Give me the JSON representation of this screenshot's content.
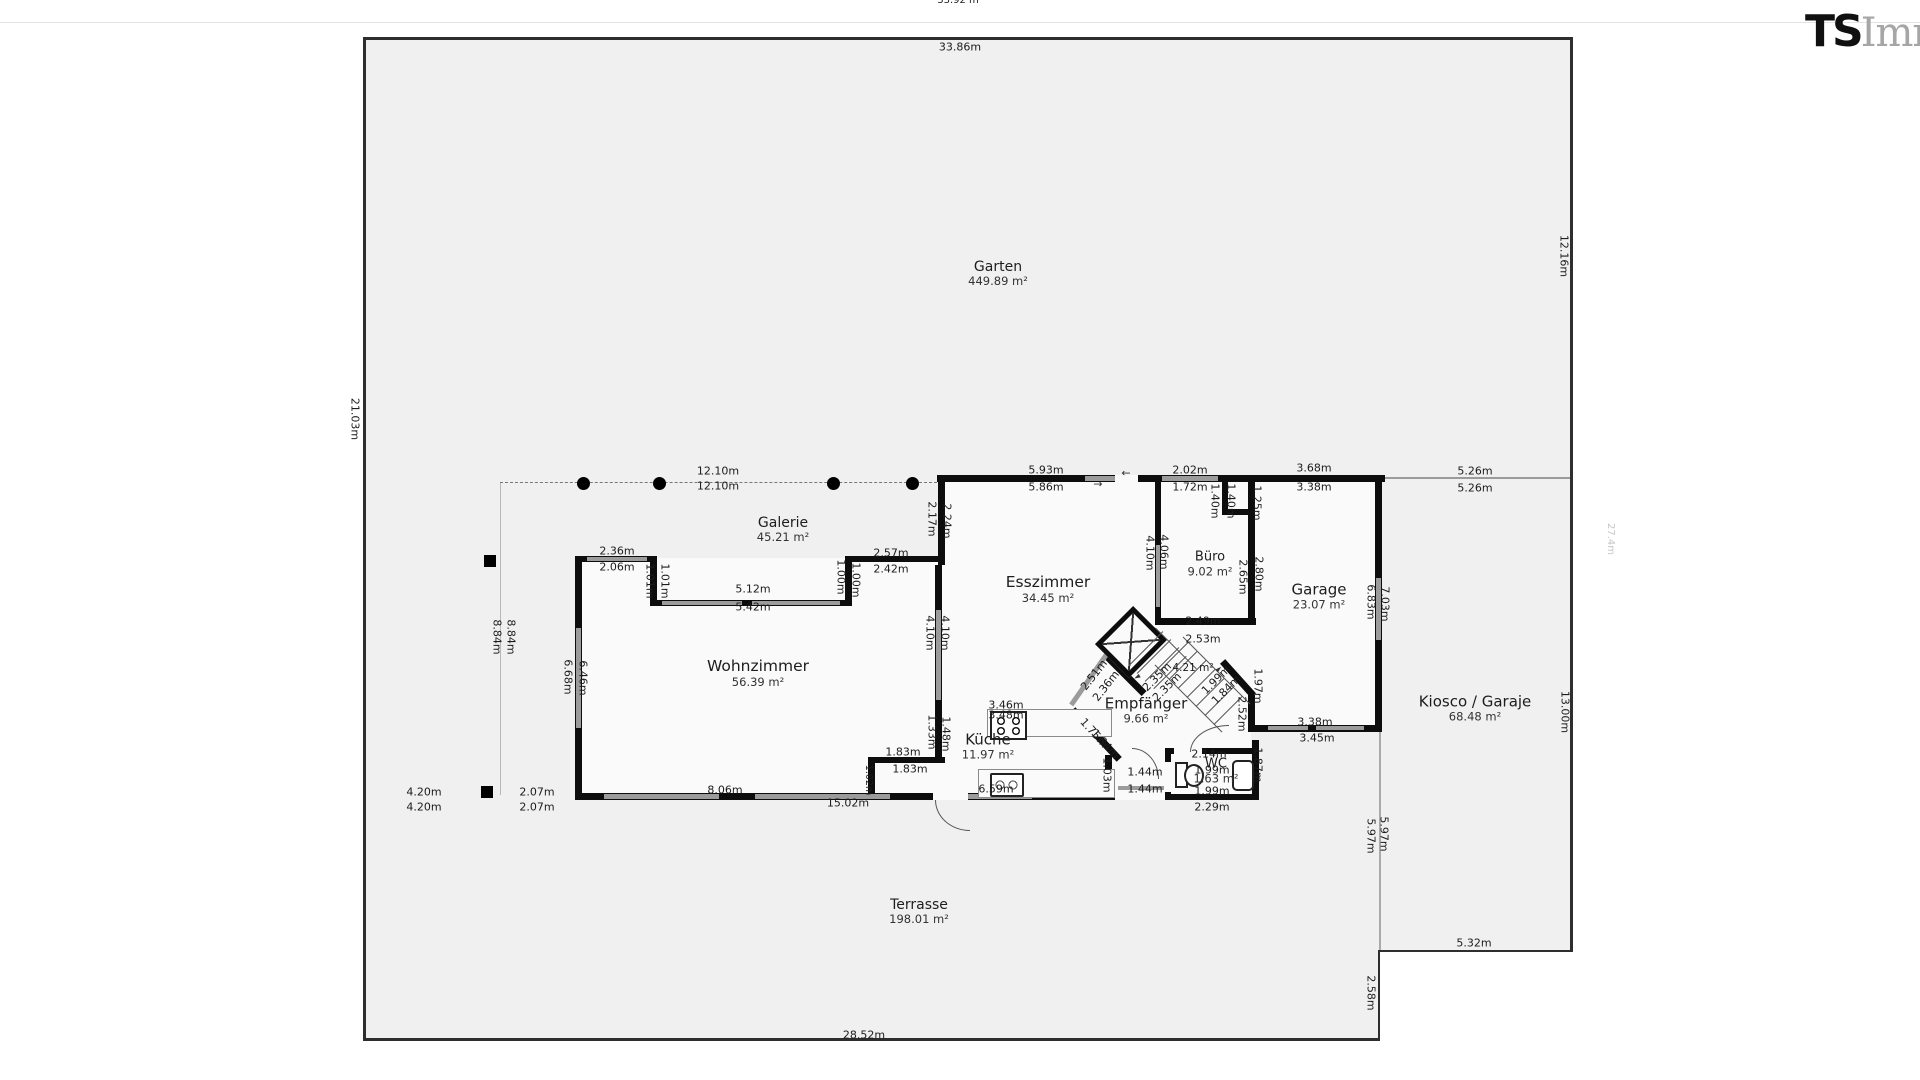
{
  "logo": {
    "bold": "TS",
    "light": "Immo"
  },
  "rooms": [
    {
      "name": "Garten",
      "area": "449.89 m²",
      "x": 998,
      "y": 274,
      "s": 14
    },
    {
      "name": "Galerie",
      "area": "45.21 m²",
      "x": 783,
      "y": 530,
      "s": 14
    },
    {
      "name": "Wohnzimmer",
      "area": "56.39 m²",
      "x": 758,
      "y": 674,
      "s": 15.5
    },
    {
      "name": "Esszimmer",
      "area": "34.45 m²",
      "x": 1048,
      "y": 590,
      "s": 15.5
    },
    {
      "name": "Büro",
      "area": "9.02 m²",
      "x": 1210,
      "y": 565,
      "s": 13
    },
    {
      "name": "Garage",
      "area": "23.07 m²",
      "x": 1319,
      "y": 597,
      "s": 15
    },
    {
      "name": "Kiosco / Garaje",
      "area": "68.48 m²",
      "x": 1475,
      "y": 709,
      "s": 15
    },
    {
      "name": "Empfänger",
      "area": "9.66 m²",
      "x": 1146,
      "y": 711,
      "s": 15
    },
    {
      "name": "Küche",
      "area": "11.97 m²",
      "x": 988,
      "y": 747,
      "s": 15
    },
    {
      "name": "WC",
      "area": "1.63 m²",
      "x": 1216,
      "y": 772,
      "s": 13
    },
    {
      "name": "Terrasse",
      "area": "198.01 m²",
      "x": 919,
      "y": 912,
      "s": 14
    }
  ],
  "dim_labels": [
    {
      "t": "33.92 m",
      "x": 958,
      "y": 1,
      "s": 10
    },
    {
      "t": "33.86m",
      "x": 960,
      "y": 47
    },
    {
      "t": "12.10m",
      "x": 718,
      "y": 471
    },
    {
      "t": "12.10m",
      "x": 718,
      "y": 486
    },
    {
      "t": "5.93m",
      "x": 1046,
      "y": 470
    },
    {
      "t": "5.86m",
      "x": 1046,
      "y": 487
    },
    {
      "t": "2.02m",
      "x": 1190,
      "y": 470
    },
    {
      "t": "1.72m",
      "x": 1190,
      "y": 487
    },
    {
      "t": "3.68m",
      "x": 1314,
      "y": 468
    },
    {
      "t": "3.38m",
      "x": 1314,
      "y": 487
    },
    {
      "t": "5.26m",
      "x": 1475,
      "y": 471
    },
    {
      "t": "5.26m",
      "x": 1475,
      "y": 488
    },
    {
      "t": "1.40m",
      "x": 1215,
      "y": 501,
      "r": 90
    },
    {
      "t": "1.40m",
      "x": 1231,
      "y": 501,
      "r": 90
    },
    {
      "t": "1.25m",
      "x": 1257,
      "y": 503,
      "r": 90
    },
    {
      "t": "2.36m",
      "x": 617,
      "y": 551
    },
    {
      "t": "2.06m",
      "x": 617,
      "y": 567
    },
    {
      "t": "1.01m",
      "x": 650,
      "y": 581,
      "r": 90
    },
    {
      "t": "1.01m",
      "x": 665,
      "y": 581,
      "r": 90
    },
    {
      "t": "5.12m",
      "x": 753,
      "y": 589
    },
    {
      "t": "5.42m",
      "x": 753,
      "y": 607
    },
    {
      "t": "1.00m",
      "x": 841,
      "y": 577,
      "r": 90
    },
    {
      "t": "1.00m",
      "x": 856,
      "y": 580,
      "r": 90
    },
    {
      "t": "2.57m",
      "x": 891,
      "y": 553
    },
    {
      "t": "2.42m",
      "x": 891,
      "y": 569
    },
    {
      "t": "2.17m",
      "x": 932,
      "y": 519,
      "r": 90
    },
    {
      "t": "2.24m",
      "x": 947,
      "y": 521,
      "r": 90
    },
    {
      "t": "4.10m",
      "x": 930,
      "y": 633,
      "r": 90
    },
    {
      "t": "4.10m",
      "x": 945,
      "y": 633,
      "r": 90
    },
    {
      "t": "4.10m",
      "x": 1150,
      "y": 553,
      "r": 90
    },
    {
      "t": "4.06m",
      "x": 1164,
      "y": 552,
      "r": 90
    },
    {
      "t": "2.49m",
      "x": 1203,
      "y": 621
    },
    {
      "t": "2.53m",
      "x": 1203,
      "y": 639
    },
    {
      "t": "2.65m",
      "x": 1243,
      "y": 577,
      "r": 90
    },
    {
      "t": "2.80m",
      "x": 1259,
      "y": 574,
      "r": 90
    },
    {
      "t": "6.83m",
      "x": 1371,
      "y": 602,
      "r": 90
    },
    {
      "t": "7.03m",
      "x": 1385,
      "y": 604,
      "r": 90
    },
    {
      "t": "3.38m",
      "x": 1315,
      "y": 722
    },
    {
      "t": "3.45m",
      "x": 1317,
      "y": 738
    },
    {
      "t": "1.97m",
      "x": 1258,
      "y": 686,
      "r": 90
    },
    {
      "t": "2.52m",
      "x": 1242,
      "y": 714,
      "r": 90
    },
    {
      "t": "1.87m",
      "x": 1258,
      "y": 765,
      "r": 90
    },
    {
      "t": "5.97m",
      "x": 1371,
      "y": 836,
      "r": 90
    },
    {
      "t": "5.97m",
      "x": 1384,
      "y": 834,
      "r": 90
    },
    {
      "t": "2.51m",
      "x": 1094,
      "y": 675,
      "r": -52
    },
    {
      "t": "2.36m",
      "x": 1106,
      "y": 686,
      "r": -52
    },
    {
      "t": "2.35m",
      "x": 1157,
      "y": 677,
      "r": -45
    },
    {
      "t": "2.35m",
      "x": 1167,
      "y": 687,
      "r": -45
    },
    {
      "t": "1.99m",
      "x": 1216,
      "y": 680,
      "r": -45
    },
    {
      "t": "1.84m",
      "x": 1226,
      "y": 690,
      "r": -45
    },
    {
      "t": "1.75m",
      "x": 1094,
      "y": 733,
      "r": 48
    },
    {
      "t": "1.84m",
      "x": 1105,
      "y": 744,
      "r": 48
    },
    {
      "t": "4.21 m²",
      "x": 1193,
      "y": 668,
      "s": 10.5
    },
    {
      "t": "2.14m",
      "x": 1209,
      "y": 754
    },
    {
      "t": "1.99m",
      "x": 1212,
      "y": 770
    },
    {
      "t": "1.99m",
      "x": 1212,
      "y": 791
    },
    {
      "t": "2.29m",
      "x": 1212,
      "y": 807
    },
    {
      "t": "1.44m",
      "x": 1145,
      "y": 772
    },
    {
      "t": "1.44m",
      "x": 1145,
      "y": 789
    },
    {
      "t": "1.03m",
      "x": 1107,
      "y": 775,
      "r": 90
    },
    {
      "t": "3.46m",
      "x": 1006,
      "y": 705
    },
    {
      "t": "3.48m",
      "x": 1006,
      "y": 715
    },
    {
      "t": "1.33m",
      "x": 932,
      "y": 732,
      "r": 90
    },
    {
      "t": "1.48m",
      "x": 946,
      "y": 734,
      "r": 90
    },
    {
      "t": "1.83m",
      "x": 903,
      "y": 752
    },
    {
      "t": "1.83m",
      "x": 910,
      "y": 769
    },
    {
      "t": "6.59m",
      "x": 996,
      "y": 789
    },
    {
      "t": "1.02m",
      "x": 868,
      "y": 780,
      "r": 90,
      "s": 9.5
    },
    {
      "t": "8.06m",
      "x": 725,
      "y": 790
    },
    {
      "t": "15.02m",
      "x": 848,
      "y": 803
    },
    {
      "t": "4.20m",
      "x": 424,
      "y": 792
    },
    {
      "t": "4.20m",
      "x": 424,
      "y": 807
    },
    {
      "t": "2.07m",
      "x": 537,
      "y": 792
    },
    {
      "t": "2.07m",
      "x": 537,
      "y": 807
    },
    {
      "t": "8.84m",
      "x": 497,
      "y": 637,
      "r": 90
    },
    {
      "t": "8.84m",
      "x": 511,
      "y": 637,
      "r": 90
    },
    {
      "t": "6.68m",
      "x": 568,
      "y": 677,
      "r": 90
    },
    {
      "t": "6.46m",
      "x": 583,
      "y": 678,
      "r": 90
    },
    {
      "t": "21.03m",
      "x": 355,
      "y": 419,
      "r": 90
    },
    {
      "t": "12.16m",
      "x": 1564,
      "y": 256,
      "r": 90
    },
    {
      "t": "13.00m",
      "x": 1565,
      "y": 712,
      "r": 90
    },
    {
      "t": "27.4m",
      "x": 1610,
      "y": 539,
      "r": 90,
      "c": "#c6c6c6",
      "s": 10
    },
    {
      "t": "5.32m",
      "x": 1474,
      "y": 943
    },
    {
      "t": "2.58m",
      "x": 1371,
      "y": 993,
      "r": 90
    },
    {
      "t": "28.52m",
      "x": 864,
      "y": 1035
    }
  ],
  "arrows": [
    {
      "t": "←",
      "x": 1126,
      "y": 473,
      "s": 11
    },
    {
      "t": "→",
      "x": 1098,
      "y": 484,
      "s": 11
    },
    {
      "t": "►",
      "x": 1219,
      "y": 669,
      "r": -42,
      "s": 8
    },
    {
      "t": "►",
      "x": 1137,
      "y": 677,
      "r": 152,
      "s": 8
    }
  ],
  "geometry": {
    "fills": [
      [
        363,
        39,
        1209,
        913,
        "#f0f0f0"
      ],
      [
        363,
        950,
        1017,
        91,
        "#f0f0f0"
      ],
      [
        577,
        558,
        364,
        240,
        "#fafafa"
      ],
      [
        941,
        475,
        310,
        325,
        "#fafafa"
      ],
      [
        1251,
        475,
        131,
        255,
        "#fafafa"
      ],
      [
        655,
        562,
        192,
        42,
        "#fafafa"
      ]
    ],
    "borders": [
      [
        363,
        37,
        1209,
        3
      ],
      [
        363,
        37,
        3,
        1004
      ],
      [
        1570,
        37,
        3,
        915
      ],
      [
        1380,
        950,
        192,
        2
      ],
      [
        1378,
        950,
        2,
        91
      ],
      [
        363,
        1038,
        1017,
        3
      ]
    ],
    "lines": [
      [
        0,
        22,
        1920,
        1,
        "#e3e3e3"
      ],
      [
        1382,
        477,
        190,
        2,
        "#9b9b9b"
      ],
      [
        1379,
        732,
        2,
        220,
        "#aaaaaa"
      ],
      [
        500,
        483,
        1,
        312,
        "#b9b9b9"
      ]
    ],
    "dashed": [
      500,
      482,
      437
    ],
    "walls": [
      [
        937,
        475,
        448,
        7
      ],
      [
        938,
        475,
        7,
        90
      ],
      [
        845,
        556,
        100,
        6
      ],
      [
        650,
        556,
        7,
        50
      ],
      [
        845,
        556,
        7,
        50
      ],
      [
        577,
        556,
        80,
        6
      ],
      [
        650,
        600,
        202,
        6
      ],
      [
        575,
        556,
        7,
        244
      ],
      [
        575,
        793,
        540,
        7
      ],
      [
        935,
        565,
        7,
        198
      ],
      [
        868,
        757,
        77,
        6
      ],
      [
        868,
        757,
        7,
        43
      ],
      [
        1105,
        755,
        7,
        45
      ],
      [
        1165,
        748,
        94,
        6
      ],
      [
        1165,
        748,
        6,
        52
      ],
      [
        1165,
        794,
        94,
        6
      ],
      [
        1252,
        740,
        7,
        60
      ],
      [
        1155,
        475,
        6,
        150
      ],
      [
        1155,
        618,
        101,
        7
      ],
      [
        1248,
        475,
        7,
        150
      ],
      [
        1248,
        695,
        7,
        37
      ],
      [
        1248,
        725,
        134,
        7
      ],
      [
        1375,
        475,
        7,
        257
      ],
      [
        1222,
        475,
        6,
        40
      ],
      [
        1222,
        509,
        32,
        6
      ]
    ],
    "diag_walls": [
      [
        1125,
        674,
        54,
        7,
        45
      ],
      [
        1238,
        678,
        46,
        7,
        48
      ],
      [
        1096,
        734,
        68,
        7,
        47
      ]
    ],
    "diag_windows": [
      [
        1089,
        679,
        62,
        5,
        -55
      ]
    ],
    "windows": [
      [
        1085,
        476,
        30,
        5
      ],
      [
        1162,
        476,
        56,
        5
      ],
      [
        587,
        557,
        60,
        4
      ],
      [
        662,
        601,
        80,
        4
      ],
      [
        752,
        601,
        88,
        4
      ],
      [
        576,
        628,
        5,
        100
      ],
      [
        936,
        610,
        5,
        90
      ],
      [
        1156,
        545,
        4,
        62
      ],
      [
        1376,
        578,
        5,
        62
      ],
      [
        604,
        794,
        115,
        5
      ],
      [
        755,
        794,
        135,
        5
      ],
      [
        950,
        794,
        82,
        5
      ],
      [
        1268,
        726,
        40,
        4
      ],
      [
        1316,
        726,
        48,
        4
      ],
      [
        1118,
        786,
        46,
        4
      ],
      [
        1174,
        750,
        28,
        3
      ]
    ],
    "gaps": [
      [
        1115,
        475,
        23,
        7
      ],
      [
        1174,
        748,
        28,
        6
      ],
      [
        1165,
        762,
        6,
        30
      ],
      [
        933,
        793,
        35,
        7
      ]
    ],
    "dots": [
      [
        583,
        483
      ],
      [
        659,
        483
      ],
      [
        833,
        483
      ],
      [
        912,
        483
      ]
    ],
    "squares": [
      [
        484,
        555,
        12,
        12
      ],
      [
        481,
        786,
        12,
        12
      ]
    ],
    "doors": [
      [
        1132,
        748,
        26,
        30,
        "tr"
      ],
      [
        1190,
        725,
        38,
        26,
        "tl"
      ],
      [
        935,
        800,
        34,
        30,
        "bl"
      ]
    ],
    "stairs": {
      "landing": [
        1104,
        618,
        44,
        38,
        -45
      ],
      "rails": [
        [
          1216,
          670,
          95,
          45
        ],
        [
          1188,
          698,
          95,
          45
        ],
        [
          1176,
          648,
          58,
          45
        ]
      ],
      "treads": [
        [
          1146,
          648,
          48
        ],
        [
          1154,
          656,
          48
        ],
        [
          1162,
          664,
          48
        ],
        [
          1170,
          672,
          46
        ],
        [
          1174,
          656,
          40
        ],
        [
          1183,
          665,
          40
        ],
        [
          1192,
          674,
          40
        ],
        [
          1201,
          683,
          40
        ],
        [
          1210,
          692,
          40
        ],
        [
          1219,
          701,
          40
        ],
        [
          1228,
          710,
          40
        ]
      ],
      "tread_rot": -45
    },
    "fixtures": [
      [
        "counter",
        987,
        709,
        123,
        26
      ],
      [
        "stove",
        990,
        711,
        33,
        25
      ],
      [
        "counter",
        978,
        769,
        135,
        27
      ],
      [
        "sink",
        990,
        773,
        30,
        20
      ],
      [
        "toilet-tank",
        1175,
        762,
        9,
        22
      ],
      [
        "toilet-bowl",
        1184,
        764,
        16,
        19
      ],
      [
        "basin",
        1232,
        760,
        18,
        27
      ]
    ]
  }
}
